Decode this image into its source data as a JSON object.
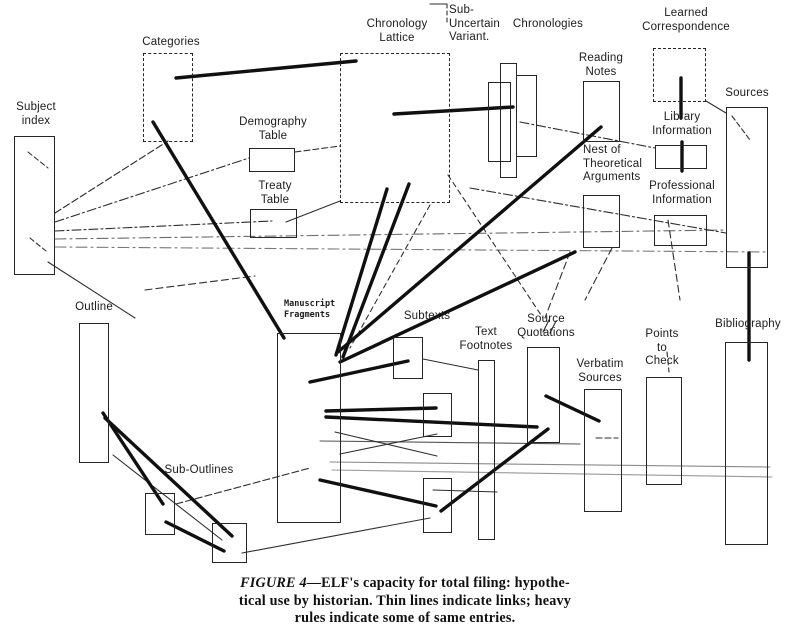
{
  "colors": {
    "paper": "#ffffff",
    "ink": "#2e2e2e",
    "heavy": "#101010"
  },
  "caption": {
    "figure_label": "FIGURE 4",
    "line1_rest": "—ELF's capacity for total filing: hypothe-",
    "line2": "tical use by historian. Thin lines indicate links; heavy",
    "line3": "rules indicate some of same entries."
  },
  "diagram": {
    "nodes": [
      {
        "id": "subject-index",
        "label": "Subject\nindex",
        "lx": 8,
        "ly": 101,
        "lw": 56,
        "boxes": [
          {
            "x": 14,
            "y": 136,
            "w": 41,
            "h": 139,
            "style": "solid"
          }
        ]
      },
      {
        "id": "categories",
        "label": "Categories",
        "lx": 133,
        "ly": 36,
        "lw": 76,
        "boxes": [
          {
            "x": 143,
            "y": 53,
            "w": 50,
            "h": 89,
            "style": "dashed"
          }
        ]
      },
      {
        "id": "demography-table",
        "label": "Demography\nTable",
        "lx": 228,
        "ly": 116,
        "lw": 90,
        "boxes": [
          {
            "x": 249,
            "y": 148,
            "w": 46,
            "h": 24,
            "style": "solid"
          }
        ]
      },
      {
        "id": "treaty-table",
        "label": "Treaty\nTable",
        "lx": 230,
        "ly": 180,
        "lw": 90,
        "boxes": [
          {
            "x": 250,
            "y": 209,
            "w": 47,
            "h": 29,
            "style": "solid"
          }
        ]
      },
      {
        "id": "chronology-lattice",
        "label": "Chronology\nLattice",
        "lx": 353,
        "ly": 18,
        "lw": 88,
        "boxes": [
          {
            "x": 340,
            "y": 53,
            "w": 110,
            "h": 150,
            "style": "dashed"
          }
        ]
      },
      {
        "id": "sub-uncertain-variant",
        "label": "Sub-\nUncertain\nVariant.",
        "lx": 449,
        "ly": 4,
        "lw": 62,
        "align": "left",
        "boxes": []
      },
      {
        "id": "chronologies",
        "label": "Chronologies",
        "lx": 510,
        "ly": 18,
        "lw": 76,
        "boxes": [
          {
            "x": 488,
            "y": 82,
            "w": 23,
            "h": 80,
            "style": "solid"
          },
          {
            "x": 500,
            "y": 63,
            "w": 17,
            "h": 115,
            "style": "solid"
          },
          {
            "x": 516,
            "y": 75,
            "w": 21,
            "h": 82,
            "style": "solid"
          }
        ]
      },
      {
        "id": "reading-notes",
        "label": "Reading\nNotes",
        "lx": 576,
        "ly": 52,
        "lw": 50,
        "boxes": [
          {
            "x": 583,
            "y": 81,
            "w": 37,
            "h": 61,
            "style": "solid"
          }
        ]
      },
      {
        "id": "learned-correspondence",
        "label": "Learned\nCorrespondence",
        "lx": 640,
        "ly": 7,
        "lw": 92,
        "boxes": [
          {
            "x": 653,
            "y": 48,
            "w": 53,
            "h": 54,
            "style": "dashed"
          }
        ]
      },
      {
        "id": "sources",
        "label": "Sources",
        "lx": 720,
        "ly": 87,
        "lw": 54,
        "boxes": [
          {
            "x": 726,
            "y": 107,
            "w": 42,
            "h": 161,
            "style": "solid"
          }
        ]
      },
      {
        "id": "library-information",
        "label": "Library\nInformation",
        "lx": 645,
        "ly": 111,
        "lw": 74,
        "boxes": [
          {
            "x": 655,
            "y": 145,
            "w": 52,
            "h": 24,
            "style": "solid"
          }
        ]
      },
      {
        "id": "professional-information",
        "label": "Professional\nInformation",
        "lx": 641,
        "ly": 180,
        "lw": 82,
        "boxes": [
          {
            "x": 654,
            "y": 215,
            "w": 53,
            "h": 31,
            "style": "solid"
          }
        ]
      },
      {
        "id": "nest-of-theoretical-arguments",
        "label": "Nest of\nTheoretical\nArguments",
        "lx": 583,
        "ly": 144,
        "lw": 68,
        "align": "left",
        "boxes": [
          {
            "x": 583,
            "y": 195,
            "w": 37,
            "h": 53,
            "style": "solid"
          }
        ]
      },
      {
        "id": "bibliography",
        "label": "Bibliography",
        "lx": 707,
        "ly": 318,
        "lw": 82,
        "boxes": [
          {
            "x": 725,
            "y": 342,
            "w": 43,
            "h": 203,
            "style": "solid"
          }
        ]
      },
      {
        "id": "outline",
        "label": "Outline",
        "lx": 69,
        "ly": 301,
        "lw": 50,
        "boxes": [
          {
            "x": 79,
            "y": 323,
            "w": 30,
            "h": 140,
            "style": "solid"
          }
        ]
      },
      {
        "id": "manuscript-fragments",
        "label": "Manuscript\nFragments",
        "lx": 284,
        "ly": 299,
        "lw": 60,
        "align": "left",
        "cls": "mono",
        "boxes": [
          {
            "x": 277,
            "y": 333,
            "w": 64,
            "h": 190,
            "style": "solid"
          }
        ]
      },
      {
        "id": "subtexts",
        "label": "Subtexts",
        "lx": 396,
        "ly": 310,
        "lw": 62,
        "boxes": [
          {
            "x": 393,
            "y": 337,
            "w": 30,
            "h": 42,
            "style": "solid"
          },
          {
            "x": 423,
            "y": 393,
            "w": 29,
            "h": 44,
            "style": "solid"
          },
          {
            "x": 423,
            "y": 478,
            "w": 29,
            "h": 55,
            "style": "solid"
          }
        ]
      },
      {
        "id": "text-footnotes",
        "label": "Text\nFootnotes",
        "lx": 454,
        "ly": 326,
        "lw": 64,
        "boxes": [
          {
            "x": 478,
            "y": 360,
            "w": 17,
            "h": 180,
            "style": "solid"
          }
        ]
      },
      {
        "id": "source-quotations",
        "label": "Source\nQuotations",
        "lx": 512,
        "ly": 313,
        "lw": 68,
        "boxes": [
          {
            "x": 527,
            "y": 347,
            "w": 33,
            "h": 96,
            "style": "solid"
          }
        ]
      },
      {
        "id": "verbatim-sources",
        "label": "Verbatim\nSources",
        "lx": 570,
        "ly": 358,
        "lw": 60,
        "boxes": [
          {
            "x": 584,
            "y": 389,
            "w": 38,
            "h": 123,
            "style": "solid"
          }
        ]
      },
      {
        "id": "points-to-check",
        "label": "Points\nto\nCheck",
        "lx": 640,
        "ly": 328,
        "lw": 44,
        "boxes": [
          {
            "x": 646,
            "y": 377,
            "w": 36,
            "h": 108,
            "style": "solid"
          }
        ]
      },
      {
        "id": "sub-outlines",
        "label": "Sub-Outlines",
        "lx": 158,
        "ly": 464,
        "lw": 82,
        "boxes": [
          {
            "x": 145,
            "y": 493,
            "w": 30,
            "h": 42,
            "style": "solid"
          },
          {
            "x": 212,
            "y": 523,
            "w": 35,
            "h": 40,
            "style": "solid"
          }
        ]
      }
    ],
    "heavy_lines": [
      [
        176,
        78,
        356,
        61
      ],
      [
        153,
        122,
        284,
        338
      ],
      [
        394,
        114,
        513,
        107
      ],
      [
        338,
        352,
        601,
        127
      ],
      [
        336,
        355,
        387,
        189
      ],
      [
        343,
        357,
        409,
        184
      ],
      [
        340,
        362,
        575,
        252
      ],
      [
        310,
        382,
        408,
        361
      ],
      [
        326,
        411,
        436,
        408
      ],
      [
        326,
        417,
        537,
        427
      ],
      [
        546,
        396,
        599,
        421
      ],
      [
        320,
        480,
        436,
        506
      ],
      [
        441,
        511,
        548,
        429
      ],
      [
        103,
        413,
        163,
        504
      ],
      [
        105,
        418,
        232,
        536
      ],
      [
        166,
        522,
        224,
        551
      ],
      [
        681,
        78,
        681,
        118
      ],
      [
        682,
        142,
        682,
        171
      ],
      [
        749,
        253,
        749,
        360
      ]
    ],
    "thin_lines": [
      {
        "p": [
          55,
          213,
          168,
          141
        ],
        "d": "7,3"
      },
      {
        "p": [
          55,
          222,
          249,
          158
        ],
        "d": "9,3,2,3"
      },
      {
        "p": [
          55,
          231,
          272,
          221
        ],
        "d": "9,3,2,3"
      },
      {
        "p": [
          286,
          222,
          340,
          201
        ]
      },
      {
        "p": [
          295,
          152,
          340,
          146
        ],
        "d": "6,3"
      },
      {
        "p": [
          55,
          239,
          726,
          230
        ],
        "d": "11,4,2,4",
        "c": "#6b6b6b"
      },
      {
        "p": [
          55,
          247,
          768,
          252
        ],
        "d": "11,4,2,4",
        "c": "#787878"
      },
      {
        "p": [
          48,
          262,
          135,
          318
        ]
      },
      {
        "p": [
          145,
          290,
          255,
          276
        ],
        "d": "7,4"
      },
      {
        "p": [
          448,
          175,
          543,
          318
        ],
        "d": "5,4"
      },
      {
        "p": [
          430,
          205,
          350,
          348
        ],
        "d": "5,4"
      },
      {
        "p": [
          520,
          122,
          655,
          148
        ],
        "d": "9,3,2,3"
      },
      {
        "p": [
          470,
          188,
          726,
          233
        ],
        "d": "9,3,2,3"
      },
      {
        "p": [
          668,
          220,
          680,
          300
        ],
        "d": "7,4"
      },
      {
        "p": [
          570,
          252,
          545,
          318
        ],
        "d": "7,4"
      },
      {
        "p": [
          612,
          248,
          585,
          300
        ],
        "d": "7,4"
      },
      {
        "p": [
          732,
          116,
          750,
          140
        ],
        "d": "5,3"
      },
      {
        "p": [
          706,
          101,
          726,
          113
        ]
      },
      {
        "p": [
          330,
          462,
          770,
          467
        ],
        "c": "#8a8a8a"
      },
      {
        "p": [
          332,
          470,
          772,
          477
        ],
        "c": "#9a9a9a"
      },
      {
        "p": [
          320,
          441,
          580,
          444
        ],
        "c": "#555555"
      },
      {
        "p": [
          335,
          432,
          437,
          456
        ]
      },
      {
        "p": [
          340,
          454,
          437,
          434
        ]
      },
      {
        "p": [
          242,
          553,
          430,
          518
        ]
      },
      {
        "p": [
          176,
          504,
          310,
          468
        ],
        "d": "7,3"
      },
      {
        "p": [
          113,
          455,
          222,
          540
        ]
      },
      {
        "p": [
          433,
          490,
          497,
          492
        ]
      },
      {
        "p": [
          430,
          4,
          447,
          4
        ]
      },
      {
        "p": [
          447,
          4,
          447,
          22
        ],
        "d": "4,3"
      },
      {
        "p": [
          28,
          152,
          48,
          168
        ],
        "d": "5,3"
      },
      {
        "p": [
          30,
          238,
          46,
          251
        ],
        "d": "5,3"
      },
      {
        "p": [
          423,
          359,
          478,
          370
        ]
      },
      {
        "p": [
          543,
          332,
          549,
          320
        ]
      },
      {
        "p": [
          550,
          333,
          556,
          321
        ]
      },
      {
        "p": [
          596,
          438,
          618,
          438
        ],
        "d": "6,3"
      },
      {
        "p": [
          667,
          352,
          669,
          372
        ],
        "d": "5,3"
      }
    ]
  }
}
